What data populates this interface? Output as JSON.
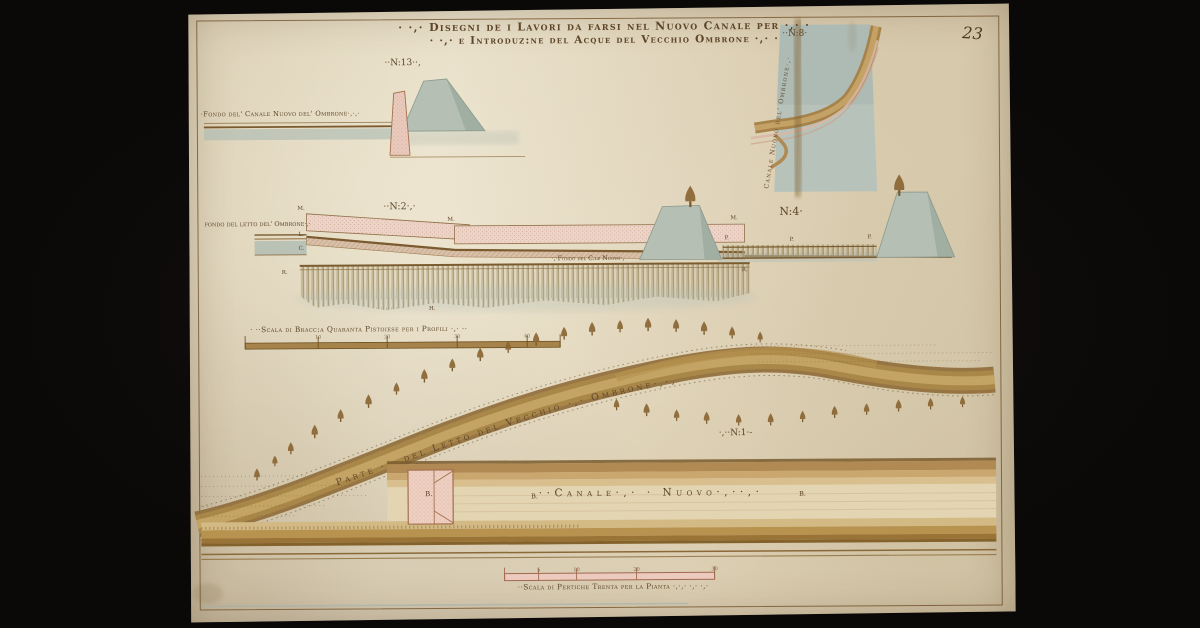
{
  "artifact": {
    "page_number": "23"
  },
  "title": {
    "line1": "· ·,· Disegni de i Lavori da farsi nel Nuovo Canale per ·,· ·",
    "line2": "· ·,· e Introduz:ne del Acque del Vecchio Ombrone ·,· ·"
  },
  "figures": {
    "n13": {
      "number": "··N:13··,",
      "bed_label": "·Fondo del' Canale Nuovo del' Ombrone·,·,·"
    },
    "n8": {
      "number": "··N:8·",
      "canal_label": "Canale Nuovo del' Ombrone·,·"
    },
    "n2": {
      "number": "··N:2·,·",
      "left_label": "fondo del letto del' Ombrone·,·",
      "bed_label": "·,·Fondo del C.le Nuovo·,",
      "markers": {
        "m1": "M.",
        "m2": "M.",
        "m3": "M.",
        "l": "L.",
        "c": "C.",
        "r1": "R.",
        "r2": "R.",
        "h": "H."
      }
    },
    "n4": {
      "number": "N:4·",
      "markers": {
        "p1": "P.",
        "p2": "P.",
        "p3": "P."
      }
    },
    "n1": {
      "number": "·,··N:1·-",
      "river_label": "Parte ·,· del Letto del Vecchio ·,· Ombrone·,·,",
      "canal_label": "··Canale·,· · Nuovo·,··,·",
      "markers": {
        "b_sluice": "B.",
        "b1": "B.",
        "b2": "B."
      }
    }
  },
  "scales": {
    "profiles": {
      "label": "· ··Scala di Bracc:a Quaranta Pistoiese per i Profili ·,· ··",
      "ticks": [
        "10",
        "20",
        "30",
        "40"
      ]
    },
    "plan": {
      "label": "··Scala di Pertiche Trenta per la Pianta ·,·,· ·,· ·,·",
      "ticks": [
        "5",
        "10",
        "20",
        "30"
      ]
    }
  }
}
